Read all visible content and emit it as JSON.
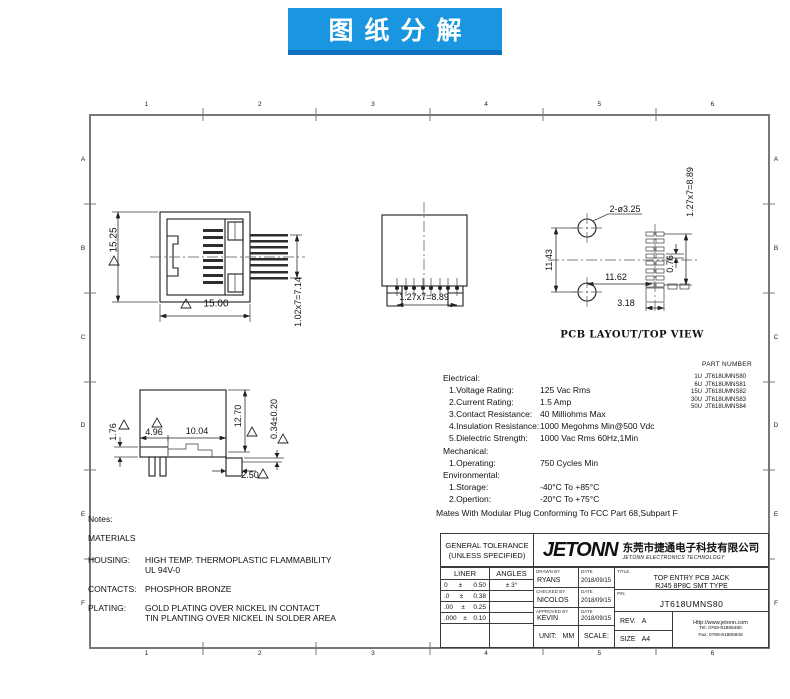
{
  "banner": {
    "text": "图纸分解",
    "bg": "#1a96e0",
    "shadow": "#0e6fc0"
  },
  "border": {
    "cols": [
      "1",
      "2",
      "3",
      "4",
      "5",
      "6"
    ],
    "rows": [
      "A",
      "B",
      "C",
      "D",
      "E",
      "F"
    ]
  },
  "views": {
    "front": {
      "dim_height": "15.25",
      "dim_width": "15.00",
      "dim_pin_pitch": "1.02x7=7.14"
    },
    "top": {
      "dim_pin_pitch": "1.27x7=8.89"
    },
    "pcb": {
      "label": "PCB LAYOUT/TOP VIEW",
      "dim_holes": "2-ø3.25",
      "dim_hole_span": "11.43",
      "dim_hole_to_pad": "11.62",
      "dim_pad_width": "0.76",
      "dim_tab_width": "3.18",
      "dim_pad_pitch": "1.27x7=8.89"
    },
    "side": {
      "dim_front_height": "1.76",
      "dim_front_len": "4.96",
      "dim_body_len": "10.04",
      "dim_height": "12.70",
      "dim_standoff": "0.34±0.20",
      "dim_foot_len": "2.50"
    }
  },
  "specs": {
    "heading_electrical": "Electrical:",
    "electrical": [
      {
        "label": "1.Voltage Rating:",
        "value": "125 Vac Rms"
      },
      {
        "label": "2.Current Rating:",
        "value": "1.5 Amp"
      },
      {
        "label": "3.Contact Resistance:",
        "value": "40 Milliohms Max"
      },
      {
        "label": "4.Insulation Resistance:",
        "value": "1000 Megohms Min@500 Vdc"
      },
      {
        "label": "5.Dielectric Strength:",
        "value": "1000 Vac Rms 60Hz,1Min"
      }
    ],
    "heading_mechanical": "Mechanical:",
    "mechanical": [
      {
        "label": "1.Operating:",
        "value": "750 Cycles Min"
      }
    ],
    "heading_environmental": "Environmental:",
    "environmental": [
      {
        "label": "1.Storage:",
        "value": "-40°C To +85°C"
      },
      {
        "label": "2.Opertion:",
        "value": "-20°C To +75°C"
      }
    ],
    "footnote": "Mates With Modular Plug Conforming To FCC Part 68,Subpart F"
  },
  "part_numbers": {
    "title": "PART NUMBER",
    "rows": [
      {
        "code": "1U",
        "pn": "JT618UMNS80"
      },
      {
        "code": "6U",
        "pn": "JT618UMNS81"
      },
      {
        "code": "15U",
        "pn": "JT618UMNS82"
      },
      {
        "code": "30U",
        "pn": "JT618UMNS83"
      },
      {
        "code": "50U",
        "pn": "JT618UMNS84"
      }
    ]
  },
  "notes": {
    "title": "Notes:",
    "materials": "MATERIALS",
    "housing_label": "HOUSING:",
    "housing_1": "HIGH TEMP. THERMOPLASTIC FLAMMABILITY",
    "housing_2": "UL 94V-0",
    "contacts_label": "CONTACTS:",
    "contacts": "PHOSPHOR BRONZE",
    "plating_label": "PLATING:",
    "plating_1": "GOLD PLATING OVER NICKEL IN CONTACT",
    "plating_2": "TIN PLANTING OVER NICKEL IN SOLDER AREA"
  },
  "titleblock": {
    "general_tolerance_line1": "GENERAL TOLERANCE",
    "general_tolerance_line2": "(UNLESS SPECIFIED)",
    "liner_header": "LINER",
    "angles_header": "ANGLES",
    "tol_rows": [
      {
        "nom": "0",
        "pm": "±",
        "val": "0.50",
        "angle": "± 3°"
      },
      {
        "nom": ".0",
        "pm": "±",
        "val": "0.38",
        "angle": ""
      },
      {
        "nom": ".00",
        "pm": "±",
        "val": "0.25",
        "angle": ""
      },
      {
        "nom": ".000",
        "pm": "±",
        "val": "0.10",
        "angle": ""
      }
    ],
    "drawn_by_label": "DRAWN BY",
    "drawn_by": "RYANS",
    "checked_by_label": "CHECKED BY",
    "checked_by": "NICOLOS",
    "approved_by_label": "APPROVED BY",
    "approved_by": "KEVIN",
    "date_label": "DATE",
    "date_drawn": "2018/09/15",
    "date_checked": "2018/09/15",
    "date_approved": "2018/09/15",
    "unit_label": "UNIT:",
    "unit_value": "MM",
    "scale_label": "SCALE:",
    "scale_value": "/",
    "title_label": "TITLE.",
    "title_line1": "TOP ENTRY PCB JACK",
    "title_line2": "RJ45 8P8C SMT TYPE",
    "pn_label": "P/N.",
    "pn_value": "JT618UMNS80",
    "rev_label": "REV.",
    "rev_value": "A",
    "size_label": "SIZE",
    "size_value": "A4",
    "logo_text": "JETONN",
    "company_cn": "东莞市捷通电子科技有限公司",
    "company_en": "JETONN ELECTRONICS TECHNOLOGY",
    "website": "Http://www.jetonn.com",
    "tel": "Tel: 0769-81885480",
    "fax": "Fax: 0769-81885948"
  }
}
